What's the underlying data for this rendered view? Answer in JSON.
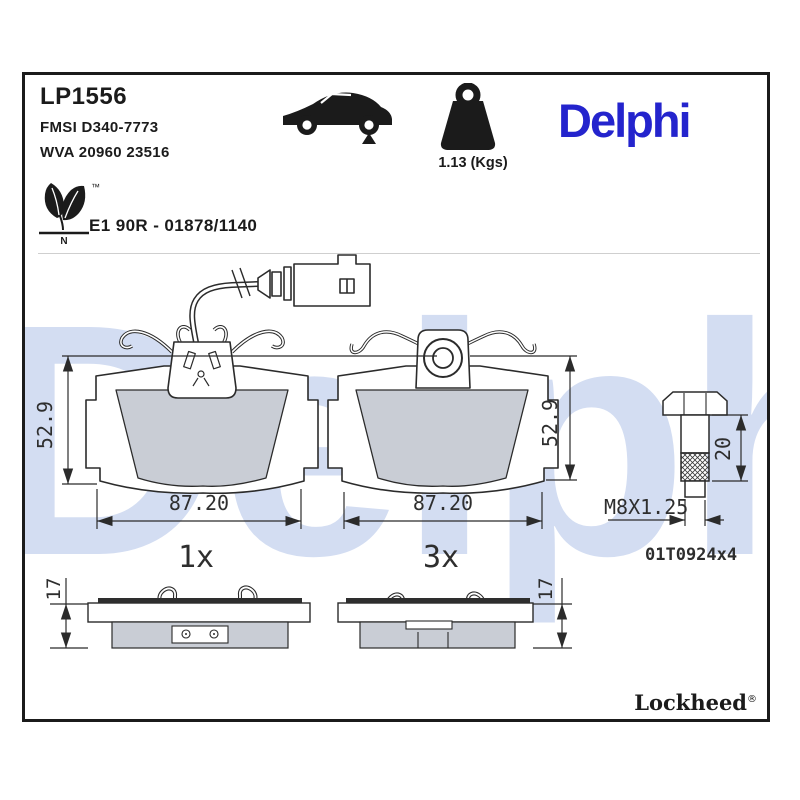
{
  "header": {
    "part_number": "LP1556",
    "fmsi": "FMSI D340-7773",
    "wva": "WVA 20960 23516",
    "weight_label": "1.13 (Kgs)",
    "brand_logo": "Delphi",
    "eco_tm": "™",
    "eco_n": "N",
    "approval": "E1 90R - 01878/1140"
  },
  "watermark": "Delphi",
  "drawings": {
    "pad_front_left": {
      "height_dim": "52.9",
      "width_dim": "87.20",
      "qty": "1x"
    },
    "pad_front_right": {
      "height_dim": "52.9",
      "width_dim": "87.20",
      "qty": "3x"
    },
    "bolt": {
      "length_dim": "20",
      "thread_label": "M8X1.25",
      "part_ref": "01T0924x4"
    },
    "pad_side_left": {
      "thickness_dim": "17"
    },
    "pad_side_right": {
      "thickness_dim": "17"
    }
  },
  "footer": {
    "brand": "Lockheed",
    "registered": "®"
  },
  "colors": {
    "brand_blue": "#2424cd",
    "watermark_blue": "#d3ddf2",
    "line": "#2b2b2b",
    "friction_gray": "#c9cdd5"
  }
}
